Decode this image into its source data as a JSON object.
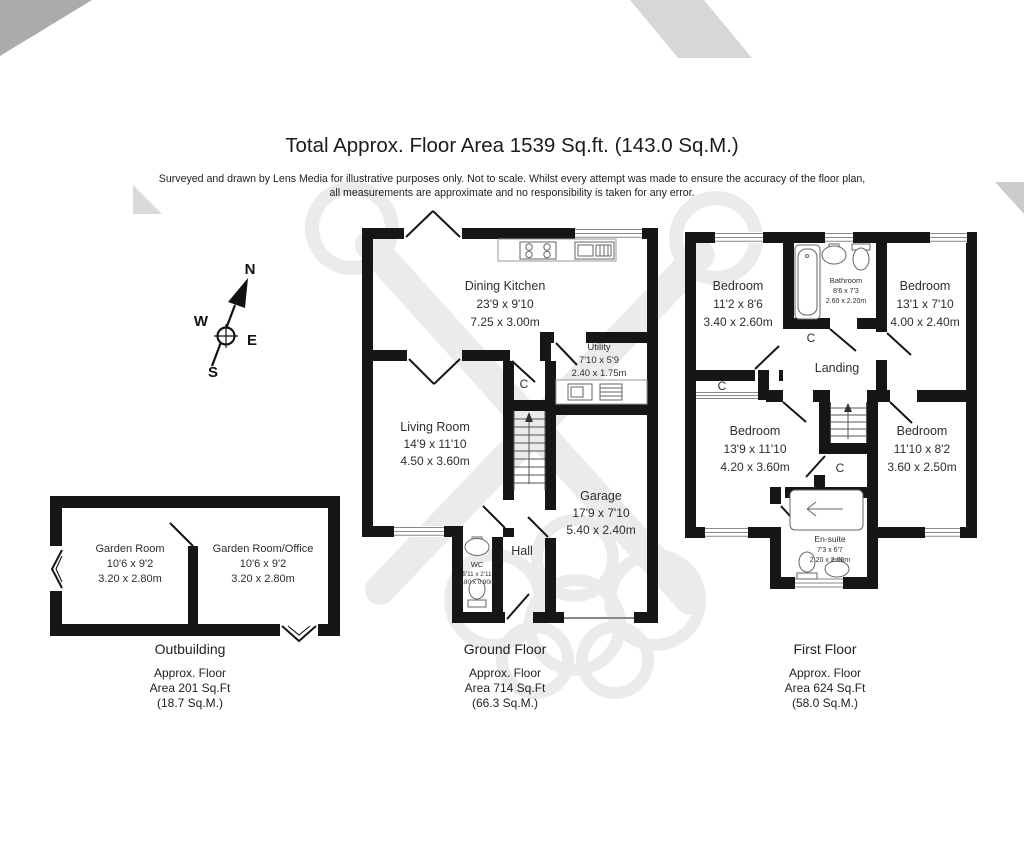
{
  "title": "Total Approx. Floor Area 1539 Sq.ft. (143.0 Sq.M.)",
  "disclaimer": {
    "line1": "Surveyed and drawn by Lens Media for illustrative purposes only. Not to scale. Whilst every attempt was made to ensure the accuracy of the floor plan,",
    "line2": "all measurements are approximate and no responsibility is taken for any error."
  },
  "compass": {
    "north": "N",
    "west": "W",
    "east": "E",
    "south": "S"
  },
  "plans": {
    "outbuilding": {
      "caption": {
        "title": "Outbuilding",
        "line1": "Approx. Floor",
        "line2": "Area 201 Sq.Ft",
        "line3": "(18.7 Sq.M.)"
      },
      "rooms": {
        "garden_room": {
          "name": "Garden Room",
          "imperial": "10'6 x 9'2",
          "metric": "3.20 x 2.80m"
        },
        "garden_room_office": {
          "name": "Garden Room/Office",
          "imperial": "10'6 x 9'2",
          "metric": "3.20 x 2.80m"
        }
      }
    },
    "ground_floor": {
      "caption": {
        "title": "Ground Floor",
        "line1": "Approx. Floor",
        "line2": "Area 714 Sq.Ft",
        "line3": "(66.3 Sq.M.)"
      },
      "rooms": {
        "dining_kitchen": {
          "name": "Dining Kitchen",
          "imperial": "23'9 x 9'10",
          "metric": "7.25 x 3.00m"
        },
        "utility": {
          "name": "Utility",
          "imperial": "7'10 x 5'9",
          "metric": "2.40 x 1.75m"
        },
        "living_room": {
          "name": "Living Room",
          "imperial": "14'9 x 11'10",
          "metric": "4.50 x 3.60m"
        },
        "garage": {
          "name": "Garage",
          "imperial": "17'9 x 7'10",
          "metric": "5.40 x 2.40m"
        },
        "hall": {
          "name": "Hall"
        },
        "wc": {
          "name": "WC",
          "imperial": "5'11 x 2'11",
          "metric": "1.80 x 0.90m"
        },
        "cupboard": {
          "name": "C"
        }
      }
    },
    "first_floor": {
      "caption": {
        "title": "First Floor",
        "line1": "Approx. Floor",
        "line2": "Area 624 Sq.Ft",
        "line3": "(58.0 Sq.M.)"
      },
      "rooms": {
        "bedroom_top_left": {
          "name": "Bedroom",
          "imperial": "11'2 x 8'6",
          "metric": "3.40 x 2.60m"
        },
        "bathroom": {
          "name": "Bathroom",
          "imperial": "8'6 x 7'3",
          "metric": "2.60 x 2.20m"
        },
        "bedroom_top_right": {
          "name": "Bedroom",
          "imperial": "13'1 x 7'10",
          "metric": "4.00 x 2.40m"
        },
        "landing": {
          "name": "Landing"
        },
        "bedroom_bottom_left": {
          "name": "Bedroom",
          "imperial": "13'9 x 11'10",
          "metric": "4.20 x 3.60m"
        },
        "bedroom_bottom_right": {
          "name": "Bedroom",
          "imperial": "11'10 x 8'2",
          "metric": "3.60 x 2.50m"
        },
        "ensuite": {
          "name": "En-suite",
          "imperial": "7'3 x 6'7",
          "metric": "2.20 x 2.00m"
        },
        "cupboard_bathroom": {
          "name": "C"
        },
        "cupboard_left": {
          "name": "C"
        },
        "cupboard_middle": {
          "name": "C"
        }
      }
    }
  },
  "colors": {
    "wall": "#161616",
    "text": "#2e2e2e",
    "watermark": "#e9e9e9"
  }
}
